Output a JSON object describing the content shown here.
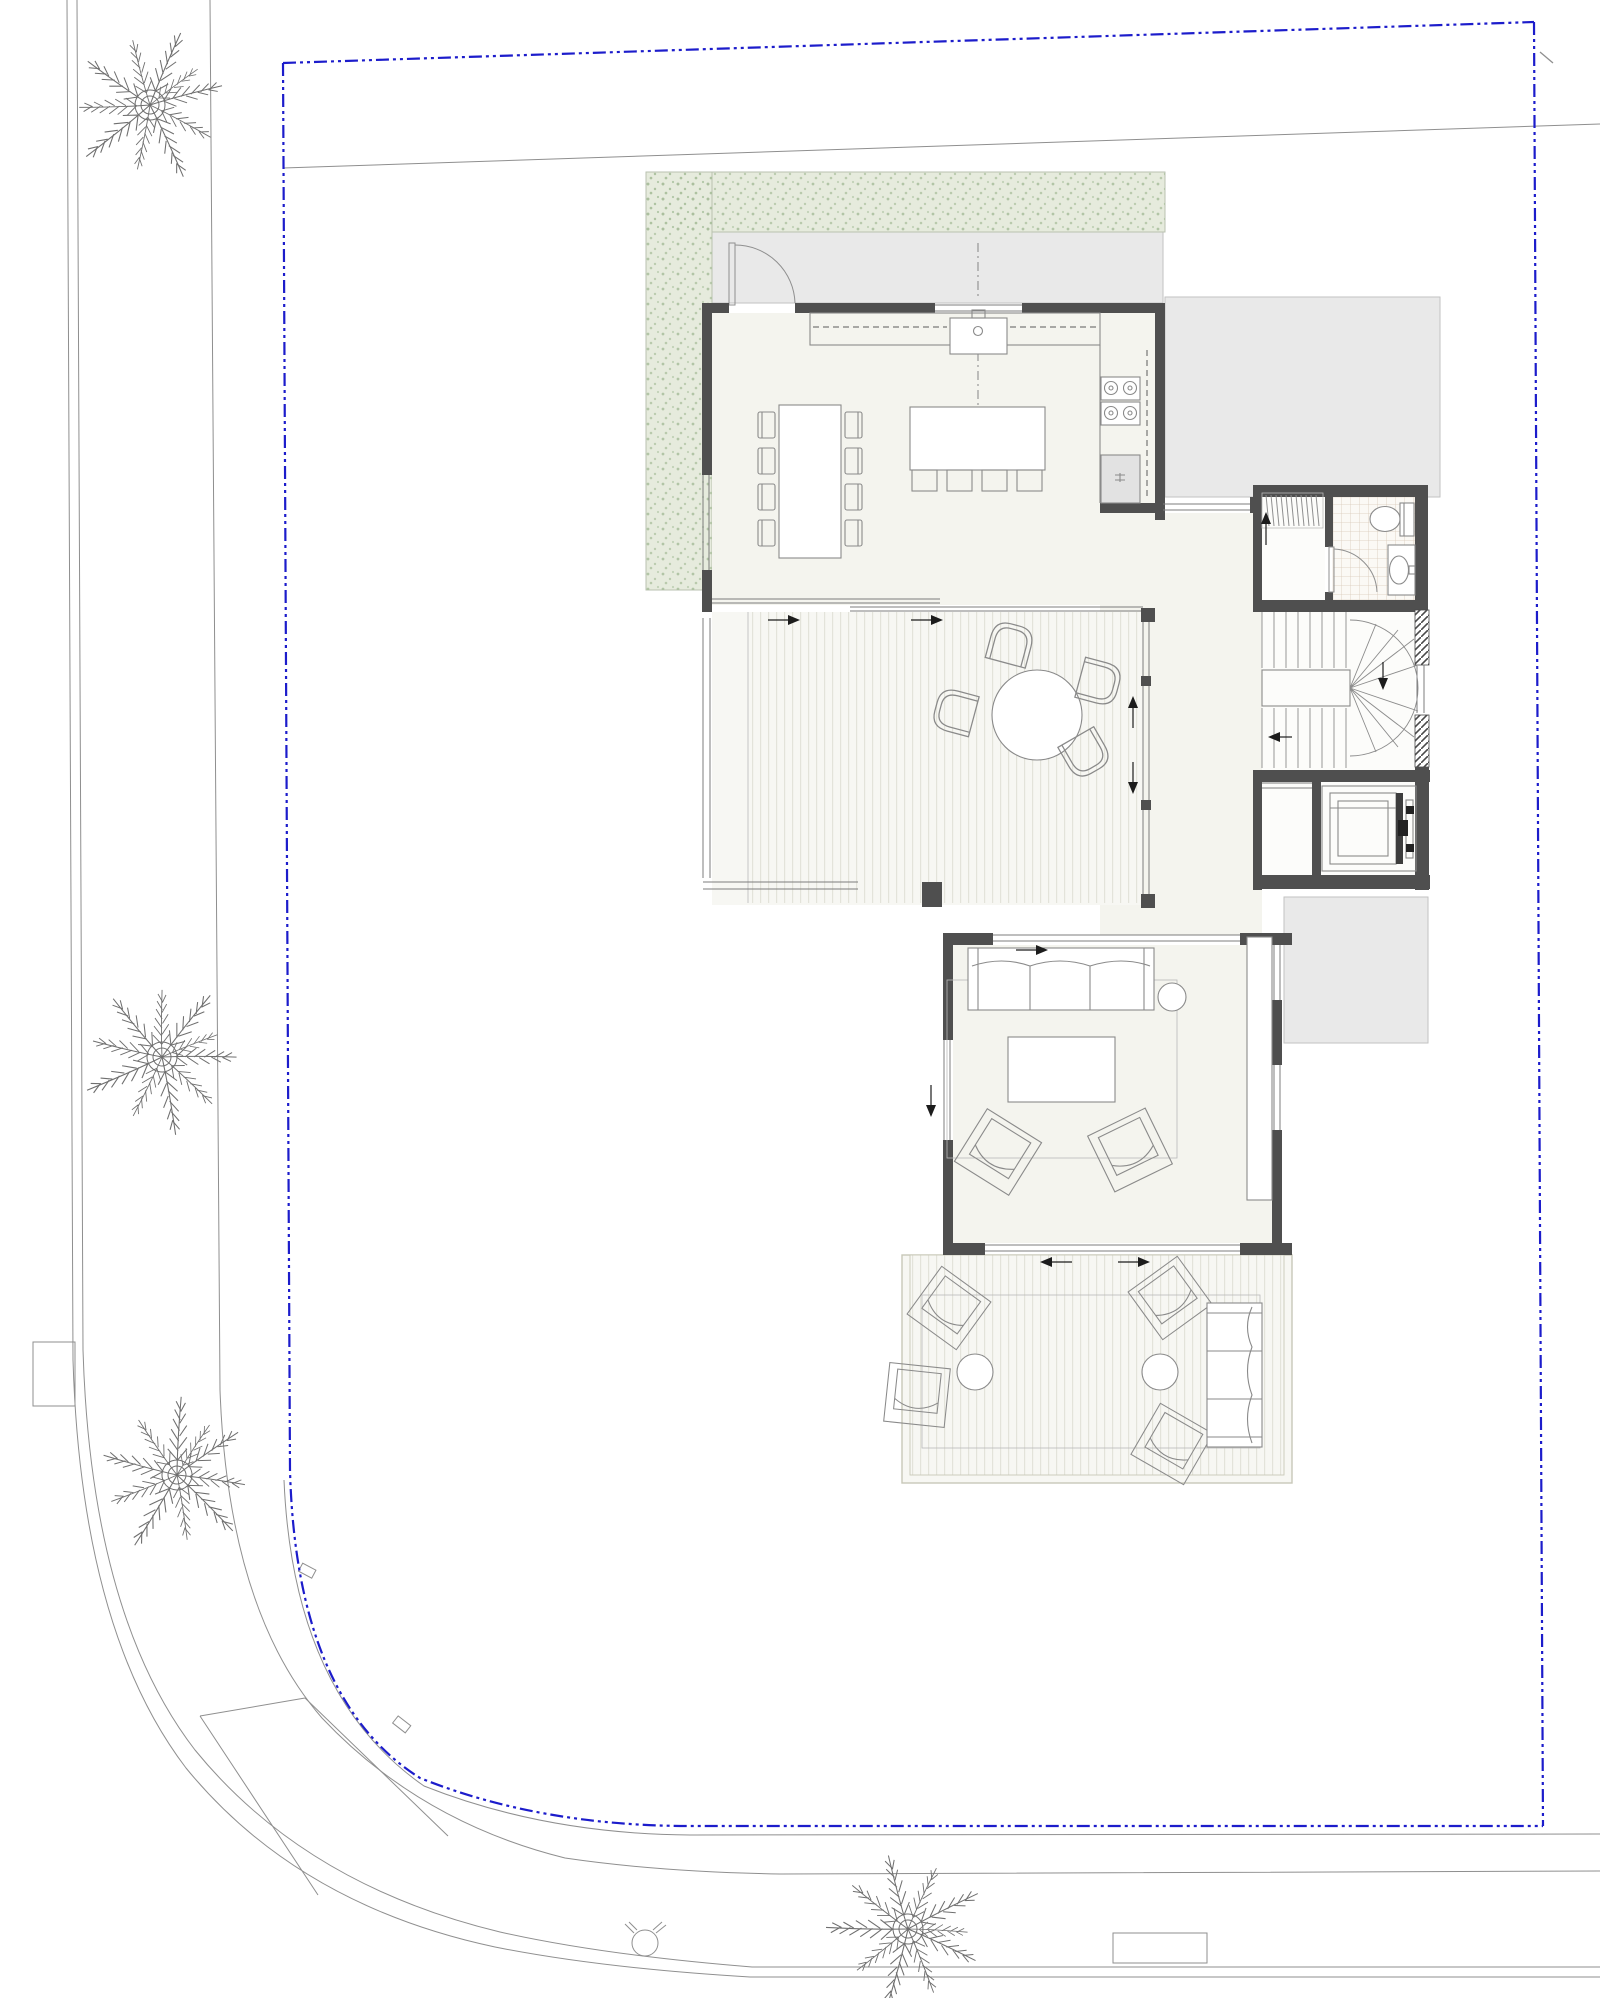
{
  "meta": {
    "drawing_type": "architectural-site-plan",
    "level": "ground-floor",
    "has_text_labels": false
  },
  "colors": {
    "boundary_blue": "#1c1ccb",
    "wall_dark": "#4f4f4f",
    "floor_cream": "#f4f4ee",
    "deck_base": "#f7f7f3",
    "deck_stripe": "#e3e3da",
    "yard_gray": "#e9e9e9",
    "yard_border": "#c2c2c2",
    "hedge_green": "#e6ebdd",
    "hedge_dot": "#a9bf9c",
    "tile_line": "#d9c9b9",
    "line_gray": "#8f8f8f",
    "furniture_line": "#8a8a8a"
  },
  "site": {
    "property_boundary": {
      "style": "dash-dot-dot",
      "shape": "rectangle with large-radius rounded south-west corner"
    },
    "streets": [
      "west-street",
      "south-street"
    ],
    "sidewalks": [
      "west-sidewalk",
      "south-sidewalk"
    ],
    "palm_trees": [
      {
        "id": "palm-nw",
        "cx": 150,
        "cy": 105
      },
      {
        "id": "palm-w-mid",
        "cx": 162,
        "cy": 1057
      },
      {
        "id": "palm-sw",
        "cx": 177,
        "cy": 1475
      },
      {
        "id": "palm-s",
        "cx": 908,
        "cy": 1929
      }
    ],
    "street_objects": [
      "utility-pad-west",
      "utility-box-south",
      "valve-symbol-south"
    ],
    "survey_line": "thin line sloping slightly up toward north-east",
    "boundary_tick": "short tick at north-east corner"
  },
  "house": {
    "rooms": [
      {
        "name": "entry-garden-hedge",
        "finish": "clipped hedge band, speckled green"
      },
      {
        "name": "entry-court",
        "finish": "gray paving",
        "elements": [
          "entry-door-swing"
        ]
      },
      {
        "name": "kitchen-dining",
        "finish": "cream floor",
        "furniture": [
          "dining-table",
          "8 dining-chairs",
          "kitchen-island",
          "4 stools",
          "wall-counter",
          "sink-with-faucet",
          "cooktop-4-burner",
          "refrigerator",
          "upper-cabinet-dashed-line"
        ]
      },
      {
        "name": "covered-patio",
        "finish": "striped decking",
        "furniture": [
          "round-table",
          "4 d-shaped-chairs"
        ],
        "openings": [
          "sliding-doors-north arrows",
          "sliding-window-east arrows"
        ]
      },
      {
        "name": "hallway",
        "finish": "cream floor"
      },
      {
        "name": "closet",
        "elements": [
          "hanger-hatch-band",
          "up-arrow"
        ]
      },
      {
        "name": "bathroom",
        "finish": "tiled floor",
        "fixtures": [
          "toilet",
          "washbasin",
          "door-swing"
        ]
      },
      {
        "name": "staircase",
        "type": "u-shaped winder stair",
        "elements": [
          "upper-flight",
          "winder-treads",
          "lower-flight",
          "down-arrow",
          "left-arrow",
          "landing-window"
        ]
      },
      {
        "name": "elevator",
        "elements": [
          "shaft",
          "car",
          "door-mechanism"
        ]
      },
      {
        "name": "living-room",
        "finish": "cream floor",
        "furniture": [
          "sofa-3-seat",
          "round-side-table",
          "coffee-table",
          "area-rug",
          "2 armchairs",
          "sideboard"
        ],
        "openings": [
          "sliding-door-north arrow",
          "window-west down-arrow",
          "sliding-doors-south arrows"
        ]
      },
      {
        "name": "south-terrace",
        "finish": "striped decking",
        "furniture": [
          "outdoor-rug",
          "4 lounge-chairs",
          "2 round-side-tables",
          "outdoor-sofa-3-seat"
        ]
      },
      {
        "name": "side-yard-north-east",
        "finish": "gray paving"
      },
      {
        "name": "side-yard-east",
        "finish": "gray paving"
      }
    ]
  }
}
